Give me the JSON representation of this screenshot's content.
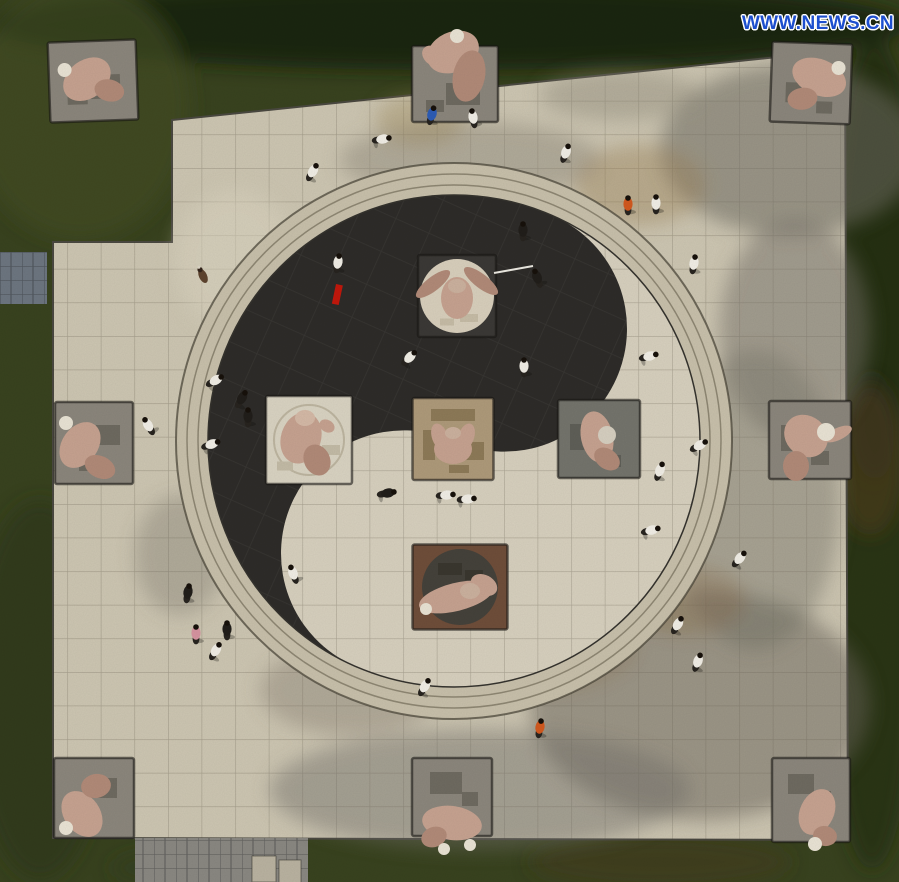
{
  "meta": {
    "description": "Aerial photograph of people practicing tai chi on a giant yin-yang (taiji) plaza surrounded by martial-arts themed stone sculptures",
    "title": "Tai chi square aerial view"
  },
  "watermark": {
    "text": "WWW.NEWS.CN",
    "color": "#1d4fce"
  },
  "palette": {
    "grass": "#39431f",
    "grass_dark": "#1b2411",
    "tile": "#cdc6b2",
    "ring": "#c8c0ab",
    "yang": "#d7d0be",
    "yin": "#2e2c29",
    "pedestal": "#8b867c",
    "pedestal_edge": "#3c3a33",
    "flesh": "#c6a290",
    "flesh_shade": "#b18a78",
    "cap": "#e9e3d4",
    "path_gray": "#6d7680",
    "pavement_gray": "#8a8882",
    "stone_block": "#b9b2a0",
    "red_accent": "#c2180c"
  },
  "taiji": {
    "cx": 454,
    "cy": 441,
    "r": 246,
    "rotation_deg": 24,
    "ring_radii": [
      278,
      267,
      256
    ],
    "yin_color": "#2e2c29",
    "yang_color": "#d7d0be"
  },
  "sculptures": [
    {
      "name": "corner-top-left",
      "cx": 93,
      "cy": 81,
      "w": 88,
      "h": 80,
      "rot": -2,
      "base": "#8b867c",
      "relief": [
        [
          12,
          6,
          30,
          24,
          "#6e6a60"
        ],
        [
          -16,
          16,
          20,
          14,
          "#6e6a60"
        ]
      ],
      "parts": [
        [
          -6,
          -2,
          26,
          19,
          -35,
          "#c6a290"
        ],
        [
          16,
          10,
          15,
          11,
          15,
          "#b18a78"
        ],
        [
          -28,
          -12,
          7,
          0,
          0,
          "#e9e3d4"
        ]
      ]
    },
    {
      "name": "edge-top-center",
      "cx": 455,
      "cy": 84,
      "w": 86,
      "h": 76,
      "rot": 0,
      "base": "#8b867c",
      "relief": [
        [
          8,
          10,
          34,
          22,
          "#6e6a60"
        ],
        [
          -20,
          22,
          18,
          12,
          "#6e6a60"
        ]
      ],
      "parts": [
        [
          -2,
          -32,
          27,
          20,
          -25,
          "#c6a290"
        ],
        [
          14,
          -8,
          16,
          26,
          12,
          "#b18a78"
        ],
        [
          -22,
          -28,
          12,
          9,
          40,
          "#c6a290"
        ],
        [
          2,
          -48,
          7,
          0,
          0,
          "#e9e3d4"
        ]
      ]
    },
    {
      "name": "corner-top-right",
      "cx": 811,
      "cy": 83,
      "w": 80,
      "h": 80,
      "rot": 2,
      "base": "#8b867c",
      "relief": [
        [
          -12,
          10,
          26,
          20,
          "#6e6a60"
        ],
        [
          14,
          24,
          16,
          12,
          "#6e6a60"
        ]
      ],
      "parts": [
        [
          8,
          -6,
          28,
          18,
          20,
          "#c6a290"
        ],
        [
          -8,
          16,
          15,
          11,
          -10,
          "#b18a78"
        ],
        [
          27,
          -16,
          7,
          0,
          0,
          "#e9e3d4"
        ]
      ]
    },
    {
      "name": "edge-left",
      "cx": 94,
      "cy": 443,
      "w": 78,
      "h": 82,
      "rot": 0,
      "base": "#8b867c",
      "relief": [
        [
          14,
          -8,
          24,
          20,
          "#6e6a60"
        ],
        [
          -6,
          22,
          18,
          12,
          "#6e6a60"
        ]
      ],
      "parts": [
        [
          -14,
          2,
          25,
          18,
          -55,
          "#c6a290"
        ],
        [
          6,
          24,
          16,
          11,
          25,
          "#b18a78"
        ],
        [
          -28,
          -20,
          7,
          0,
          0,
          "#e9e3d4"
        ]
      ]
    },
    {
      "name": "edge-right",
      "cx": 810,
      "cy": 440,
      "w": 82,
      "h": 78,
      "rot": 0,
      "base": "#8b867c",
      "relief": [
        [
          -18,
          -2,
          22,
          26,
          "#6e6a60"
        ],
        [
          10,
          18,
          18,
          14,
          "#6e6a60"
        ]
      ],
      "parts": [
        [
          -4,
          -4,
          23,
          20,
          40,
          "#c6a290"
        ],
        [
          -14,
          26,
          13,
          15,
          0,
          "#b18a78"
        ],
        [
          28,
          -6,
          15,
          6,
          -25,
          "#c6a290"
        ],
        [
          16,
          -8,
          9,
          0,
          0,
          "#e9e3d4"
        ]
      ]
    },
    {
      "name": "corner-bottom-left",
      "cx": 94,
      "cy": 798,
      "w": 80,
      "h": 80,
      "rot": 0,
      "base": "#8b867c",
      "relief": [
        [
          10,
          -10,
          26,
          20,
          "#6e6a60"
        ],
        [
          -14,
          4,
          16,
          14,
          "#6e6a60"
        ]
      ],
      "parts": [
        [
          -12,
          16,
          25,
          18,
          55,
          "#c6a290"
        ],
        [
          2,
          -12,
          15,
          12,
          -10,
          "#b18a78"
        ],
        [
          -28,
          30,
          7,
          0,
          0,
          "#e9e3d4"
        ]
      ]
    },
    {
      "name": "edge-bottom-center",
      "cx": 452,
      "cy": 797,
      "w": 80,
      "h": 78,
      "rot": 0,
      "base": "#8b867c",
      "relief": [
        [
          -6,
          -14,
          32,
          22,
          "#6e6a60"
        ],
        [
          18,
          2,
          16,
          14,
          "#6e6a60"
        ]
      ],
      "parts": [
        [
          0,
          26,
          30,
          17,
          8,
          "#c6a290"
        ],
        [
          -18,
          40,
          13,
          10,
          -20,
          "#b18a78"
        ],
        [
          -8,
          52,
          6,
          0,
          0,
          "#e9e3d4"
        ],
        [
          18,
          48,
          6,
          0,
          0,
          "#e9e3d4"
        ]
      ]
    },
    {
      "name": "corner-bottom-right",
      "cx": 811,
      "cy": 800,
      "w": 78,
      "h": 84,
      "rot": 0,
      "base": "#8b867c",
      "relief": [
        [
          -10,
          -16,
          26,
          20,
          "#6e6a60"
        ],
        [
          12,
          -2,
          16,
          14,
          "#6e6a60"
        ]
      ],
      "parts": [
        [
          6,
          12,
          24,
          17,
          -65,
          "#c6a290"
        ],
        [
          14,
          36,
          12,
          10,
          10,
          "#b18a78"
        ],
        [
          4,
          44,
          7,
          0,
          0,
          "#e9e3d4"
        ]
      ]
    },
    {
      "name": "inner-yang-dot-bull",
      "cx": 457,
      "cy": 296,
      "w": 78,
      "h": 82,
      "rot": 0,
      "base": "#3b3936",
      "circle": {
        "r": 37,
        "fill": "#d8cfbc"
      },
      "relief": [
        [
          12,
          22,
          18,
          8,
          "#c6bca6"
        ],
        [
          -10,
          26,
          14,
          7,
          "#c6bca6"
        ]
      ],
      "parts": [
        [
          -24,
          -12,
          21,
          7,
          -38,
          "#b18a78"
        ],
        [
          24,
          -15,
          21,
          7,
          38,
          "#b18a78"
        ],
        [
          0,
          2,
          16,
          21,
          0,
          "#c6a290"
        ],
        [
          0,
          -10,
          9,
          7,
          0,
          "#cbb19e"
        ]
      ]
    },
    {
      "name": "inner-left",
      "cx": 309,
      "cy": 440,
      "w": 86,
      "h": 88,
      "rot": 0,
      "base": "#d9d3c2",
      "circle": {
        "r": 35,
        "fill": "none",
        "stroke": "#bdb5a0"
      },
      "relief": [
        [
          22,
          10,
          18,
          10,
          "#c3bba6"
        ],
        [
          -24,
          26,
          16,
          9,
          "#c3bba6"
        ]
      ],
      "parts": [
        [
          -8,
          -2,
          20,
          26,
          18,
          "#c6a290"
        ],
        [
          8,
          20,
          13,
          16,
          -25,
          "#b18a78"
        ],
        [
          -4,
          -22,
          10,
          8,
          0,
          "#d4b9a6"
        ],
        [
          18,
          -14,
          8,
          6,
          30,
          "#c6a290"
        ]
      ]
    },
    {
      "name": "inner-center",
      "cx": 453,
      "cy": 439,
      "w": 81,
      "h": 82,
      "rot": 0,
      "base": "#ae9a7a",
      "relief": [
        [
          0,
          -24,
          44,
          12,
          "#8d7a58"
        ],
        [
          -24,
          6,
          12,
          30,
          "#8d7a58"
        ],
        [
          18,
          12,
          26,
          18,
          "#8d7a58"
        ],
        [
          6,
          30,
          20,
          8,
          "#8d7a58"
        ]
      ],
      "parts": [
        [
          0,
          10,
          19,
          15,
          0,
          "#c6a290"
        ],
        [
          -13,
          -2,
          8,
          14,
          -20,
          "#c6a290"
        ],
        [
          13,
          -2,
          8,
          14,
          20,
          "#c6a290"
        ],
        [
          0,
          -6,
          8,
          6,
          0,
          "#cbb19e"
        ]
      ]
    },
    {
      "name": "inner-right",
      "cx": 599,
      "cy": 439,
      "w": 82,
      "h": 78,
      "rot": 0,
      "base": "#74746c",
      "relief": [
        [
          -20,
          -2,
          18,
          26,
          "#5f5f58"
        ],
        [
          12,
          22,
          20,
          12,
          "#5f5f58"
        ]
      ],
      "parts": [
        [
          -2,
          -2,
          16,
          26,
          -12,
          "#c6a290"
        ],
        [
          8,
          20,
          14,
          10,
          35,
          "#b18a78"
        ],
        [
          8,
          -4,
          9,
          0,
          0,
          "#d6cfc0"
        ]
      ]
    },
    {
      "name": "inner-yin-dot",
      "cx": 460,
      "cy": 587,
      "w": 95,
      "h": 85,
      "rot": 0,
      "base": "#6f4e3a",
      "circle": {
        "r": 38,
        "fill": "#45423b"
      },
      "relief": [
        [
          -10,
          -18,
          24,
          12,
          "#3a372f"
        ],
        [
          14,
          -12,
          18,
          10,
          "#3a372f"
        ]
      ],
      "parts": [
        [
          -4,
          10,
          38,
          14,
          -14,
          "#c6a290"
        ],
        [
          24,
          -2,
          14,
          10,
          28,
          "#c6a290"
        ],
        [
          -34,
          22,
          6,
          0,
          0,
          "#e9e3d4"
        ],
        [
          10,
          4,
          10,
          8,
          0,
          "#cbb19e"
        ]
      ]
    }
  ],
  "person_colors": {
    "w": "#f1eee6",
    "k": "#211e1a",
    "b": "#2d5cb5",
    "o": "#d2591f",
    "p": "#d594a0"
  },
  "people": [
    [
      432,
      114,
      "b",
      15
    ],
    [
      473,
      117,
      "w",
      -10
    ],
    [
      383,
      139,
      "w",
      80
    ],
    [
      313,
      171,
      "w",
      30
    ],
    [
      566,
      152,
      "w",
      20
    ],
    [
      628,
      204,
      "o",
      0
    ],
    [
      656,
      203,
      "w",
      0
    ],
    [
      694,
      263,
      "w",
      10
    ],
    [
      523,
      230,
      "k",
      0
    ],
    [
      537,
      277,
      "k",
      -20
    ],
    [
      338,
      262,
      "w",
      10
    ],
    [
      410,
      357,
      "w",
      45
    ],
    [
      524,
      366,
      "w",
      0
    ],
    [
      216,
      380,
      "w",
      60
    ],
    [
      242,
      398,
      "k",
      30
    ],
    [
      248,
      416,
      "k",
      0
    ],
    [
      148,
      425,
      "w",
      -30
    ],
    [
      212,
      444,
      "w",
      70
    ],
    [
      388,
      493,
      "k",
      80
    ],
    [
      447,
      495,
      "w",
      85
    ],
    [
      468,
      499,
      "w",
      85
    ],
    [
      650,
      356,
      "w",
      75
    ],
    [
      700,
      445,
      "w",
      60
    ],
    [
      660,
      470,
      "w",
      20
    ],
    [
      652,
      530,
      "w",
      75
    ],
    [
      740,
      558,
      "w",
      40
    ],
    [
      678,
      624,
      "w",
      30
    ],
    [
      698,
      661,
      "w",
      20
    ],
    [
      425,
      686,
      "w",
      30
    ],
    [
      540,
      727,
      "o",
      10
    ],
    [
      293,
      573,
      "w",
      -20
    ],
    [
      188,
      592,
      "k",
      10
    ],
    [
      196,
      633,
      "p",
      0
    ],
    [
      216,
      650,
      "w",
      30
    ],
    [
      227,
      629,
      "k",
      0
    ]
  ],
  "props": {
    "sword": {
      "x1": 494,
      "y1": 273,
      "x2": 533,
      "y2": 266,
      "color": "#eceae2"
    },
    "ribbon": {
      "x": 336,
      "y": 284,
      "w": 7,
      "h": 20,
      "rot": 12,
      "color": "#c2180c"
    },
    "dog": {
      "x": 203,
      "y": 276,
      "rot": -25,
      "body": "#5d432e",
      "head": "#33241a"
    },
    "stone_blocks": [
      [
        252,
        856,
        24,
        26
      ],
      [
        279,
        860,
        22,
        24
      ]
    ]
  }
}
